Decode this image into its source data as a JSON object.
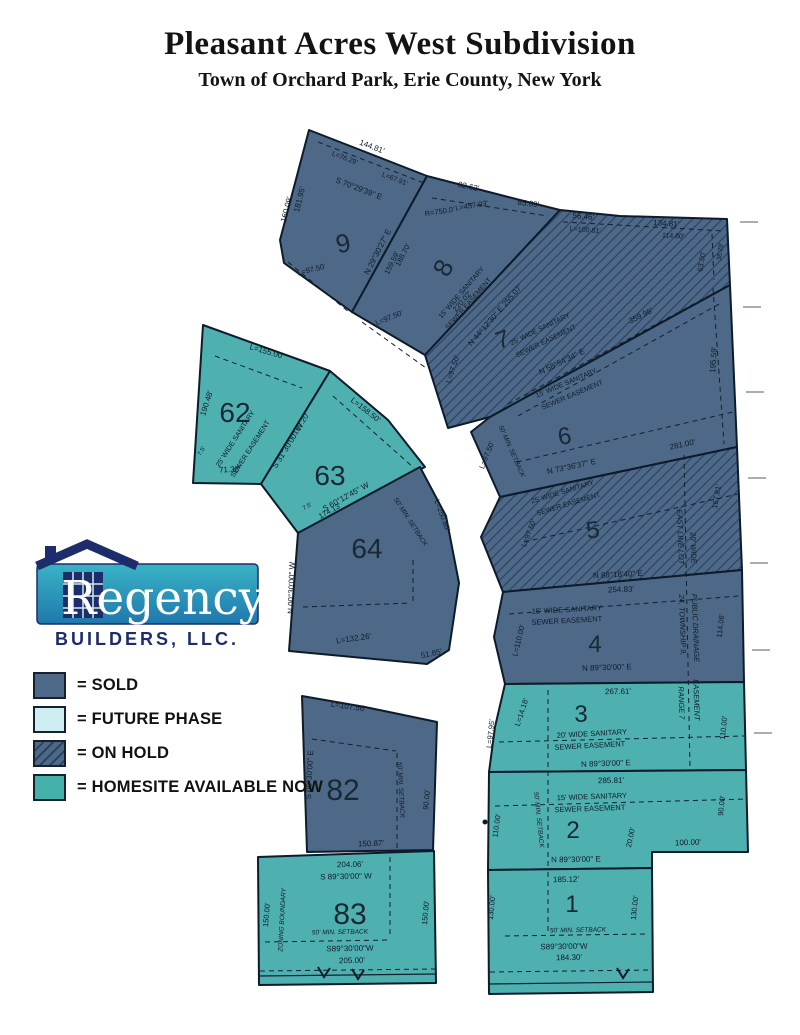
{
  "header": {
    "title": "Pleasant Acres West Subdivision",
    "subtitle": "Town of Orchard Park, Erie County, New York"
  },
  "logo": {
    "name": "Regency",
    "tagline": "BUILDERS, LLC."
  },
  "legend": {
    "items": [
      {
        "label": "= SOLD",
        "type": "sold"
      },
      {
        "label": "= FUTURE PHASE",
        "type": "future"
      },
      {
        "label": "= ON HOLD",
        "type": "onhold"
      },
      {
        "label": "= HOMESITE AVAILABLE NOW",
        "type": "available"
      }
    ]
  },
  "map": {
    "colors": {
      "sold": "#4d6987",
      "avail": "#4fb0b0",
      "legendavail": "#46b0ab",
      "future": "#cfeef2",
      "hatchline": "#2c4265"
    },
    "lots": [
      {
        "number": "1",
        "status": "available"
      },
      {
        "number": "2",
        "status": "available"
      },
      {
        "number": "3",
        "status": "available"
      },
      {
        "number": "4",
        "status": "sold"
      },
      {
        "number": "5",
        "status": "on hold"
      },
      {
        "number": "6",
        "status": "sold"
      },
      {
        "number": "7",
        "status": "on hold"
      },
      {
        "number": "8",
        "status": "sold"
      },
      {
        "number": "9",
        "status": "sold"
      },
      {
        "number": "62",
        "status": "available"
      },
      {
        "number": "63",
        "status": "available"
      },
      {
        "number": "64",
        "status": "sold"
      },
      {
        "number": "82",
        "status": "sold"
      },
      {
        "number": "83",
        "status": "available"
      }
    ],
    "numbers": [
      {
        "n": "9",
        "x": 345,
        "y": 252,
        "r": -12,
        "s": 26
      },
      {
        "n": "8",
        "x": 451,
        "y": 272,
        "r": -62,
        "s": 26
      },
      {
        "n": "7",
        "x": 505,
        "y": 347,
        "r": -18,
        "s": 24
      },
      {
        "n": "6",
        "x": 566,
        "y": 444,
        "r": -10,
        "s": 24
      },
      {
        "n": "5",
        "x": 594,
        "y": 538,
        "r": -8,
        "s": 24
      },
      {
        "n": "4",
        "x": 595,
        "y": 652,
        "r": 0,
        "s": 24
      },
      {
        "n": "3",
        "x": 581,
        "y": 722,
        "r": 0,
        "s": 24
      },
      {
        "n": "2",
        "x": 573,
        "y": 838,
        "r": 0,
        "s": 24
      },
      {
        "n": "1",
        "x": 572,
        "y": 912,
        "r": 0,
        "s": 24
      },
      {
        "n": "62",
        "x": 235,
        "y": 422,
        "r": 0,
        "s": 28
      },
      {
        "n": "63",
        "x": 330,
        "y": 485,
        "r": 0,
        "s": 28
      },
      {
        "n": "64",
        "x": 367,
        "y": 558,
        "r": 0,
        "s": 28
      },
      {
        "n": "82",
        "x": 343,
        "y": 800,
        "r": 0,
        "s": 30
      },
      {
        "n": "83",
        "x": 350,
        "y": 924,
        "r": 0,
        "s": 30
      }
    ],
    "labels": [
      {
        "t": "144.81'",
        "x": 371,
        "y": 149,
        "r": 21
      },
      {
        "t": "L=76.29'",
        "x": 344,
        "y": 160,
        "r": 21,
        "s": 7
      },
      {
        "t": "L=67.91'",
        "x": 394,
        "y": 181,
        "r": 21,
        "s": 7
      },
      {
        "t": "S 70°29'39\" E",
        "x": 358,
        "y": 191,
        "r": 21
      },
      {
        "t": "160.09'",
        "x": 289,
        "y": 210,
        "r": -76
      },
      {
        "t": "181.95'",
        "x": 302,
        "y": 200,
        "r": -76
      },
      {
        "t": "L=97.50'",
        "x": 312,
        "y": 272,
        "r": -14,
        "s": 7.5
      },
      {
        "t": "N 29°30'27\" E",
        "x": 380,
        "y": 253,
        "r": -63
      },
      {
        "t": "159.59'",
        "x": 394,
        "y": 264,
        "r": -63,
        "s": 7.5
      },
      {
        "t": "188.70'",
        "x": 405,
        "y": 256,
        "r": -63,
        "s": 7.5
      },
      {
        "t": "82.62'",
        "x": 468,
        "y": 189,
        "r": 12
      },
      {
        "t": "R=750.0'",
        "x": 440,
        "y": 214,
        "r": -9,
        "s": 7.5
      },
      {
        "t": "L=457.93'",
        "x": 472,
        "y": 208,
        "r": -9,
        "s": 7.5
      },
      {
        "t": "85.69'",
        "x": 528,
        "y": 206,
        "r": 7
      },
      {
        "t": "L=97.50'",
        "x": 390,
        "y": 320,
        "r": -22,
        "s": 7.5
      },
      {
        "t": "15' WIDE SANITARY",
        "x": 463,
        "y": 294,
        "r": -49,
        "s": 7
      },
      {
        "t": "SEWER EASEMENT",
        "x": 470,
        "y": 305,
        "r": -49,
        "s": 7
      },
      {
        "t": "N 44°12'30\" E  255.07'",
        "x": 497,
        "y": 317,
        "r": -49
      },
      {
        "t": "220.02'",
        "x": 464,
        "y": 303,
        "r": -49,
        "s": 7.5
      },
      {
        "t": "L=97.50'",
        "x": 455,
        "y": 370,
        "r": -72,
        "s": 7.5
      },
      {
        "t": "56.46'",
        "x": 583,
        "y": 219,
        "r": 5
      },
      {
        "t": "L=100.81'",
        "x": 585,
        "y": 232,
        "r": 5,
        "s": 7
      },
      {
        "t": "134.81'",
        "x": 666,
        "y": 226,
        "r": 4
      },
      {
        "t": "114.80'",
        "x": 673,
        "y": 238,
        "r": 4,
        "s": 7
      },
      {
        "t": "38.29'",
        "x": 722,
        "y": 252,
        "r": -83,
        "s": 6.5
      },
      {
        "t": "63.30'",
        "x": 704,
        "y": 262,
        "r": -80,
        "s": 7.5
      },
      {
        "t": "25' WIDE SANITARY",
        "x": 541,
        "y": 331,
        "r": -26,
        "s": 7
      },
      {
        "t": "SEWER EASEMENT",
        "x": 547,
        "y": 343,
        "r": -26,
        "s": 7
      },
      {
        "t": "N 58°54'34\" E",
        "x": 563,
        "y": 364,
        "r": -26
      },
      {
        "t": "359.96'",
        "x": 642,
        "y": 318,
        "r": -26
      },
      {
        "t": "195.59'",
        "x": 716,
        "y": 360,
        "r": -86
      },
      {
        "t": "15' WIDE SANITARY",
        "x": 567,
        "y": 385,
        "r": -23,
        "s": 7
      },
      {
        "t": "SEWER EASEMENT",
        "x": 573,
        "y": 397,
        "r": -23,
        "s": 7
      },
      {
        "t": "50' MIN. SETBACK",
        "x": 510,
        "y": 452,
        "r": 66,
        "s": 6.5,
        "i": 1
      },
      {
        "t": "N 73°36'37\" E",
        "x": 572,
        "y": 469,
        "r": -12
      },
      {
        "t": "281.00'",
        "x": 683,
        "y": 447,
        "r": -12
      },
      {
        "t": "L=97.50'",
        "x": 489,
        "y": 456,
        "r": -68,
        "s": 7.5
      },
      {
        "t": "L=97.50'",
        "x": 531,
        "y": 534,
        "r": -68,
        "s": 7.5
      },
      {
        "t": "25' WIDE SANITARY",
        "x": 563,
        "y": 494,
        "r": -17,
        "s": 7
      },
      {
        "t": "SEWER EASEMENT",
        "x": 569,
        "y": 506,
        "r": -17,
        "s": 7
      },
      {
        "t": "N 88°18'40\" E",
        "x": 618,
        "y": 577,
        "r": -3
      },
      {
        "t": "167.81'",
        "x": 719,
        "y": 497,
        "r": -80,
        "s": 7.5
      },
      {
        "t": "EAST LINE LOT",
        "x": 678,
        "y": 537,
        "r": 88,
        "s": 7.5,
        "i": 1
      },
      {
        "t": "24, TOWNSHIP 9,",
        "x": 680,
        "y": 625,
        "r": 88,
        "s": 7.5,
        "i": 1
      },
      {
        "t": "RANGE 7",
        "x": 679,
        "y": 703,
        "r": 88,
        "s": 7.5,
        "i": 1
      },
      {
        "t": "20' WIDE",
        "x": 691,
        "y": 548,
        "r": 88,
        "s": 7.5,
        "i": 1
      },
      {
        "t": "PUBLIC DRAINAGE",
        "x": 693,
        "y": 628,
        "r": 88,
        "s": 7.5,
        "i": 1
      },
      {
        "t": "EASEMENT",
        "x": 694,
        "y": 700,
        "r": 88,
        "s": 7.5,
        "i": 1
      },
      {
        "t": "254.83'",
        "x": 621,
        "y": 592,
        "r": -2
      },
      {
        "t": "15' WIDE SANITARY",
        "x": 567,
        "y": 612,
        "r": -3,
        "s": 7.5
      },
      {
        "t": "SEWER EASEMENT",
        "x": 567,
        "y": 623,
        "r": -3,
        "s": 7.5
      },
      {
        "t": "N 89°30'00\" E",
        "x": 607,
        "y": 670,
        "r": -2
      },
      {
        "t": "L=110.00'",
        "x": 521,
        "y": 641,
        "r": -76,
        "s": 7.5
      },
      {
        "t": "114.06'",
        "x": 723,
        "y": 626,
        "r": -84,
        "s": 7.5
      },
      {
        "t": "267.61'",
        "x": 618,
        "y": 694,
        "r": -1
      },
      {
        "t": "20' WIDE SANITARY",
        "x": 592,
        "y": 736,
        "r": -3,
        "s": 7.5
      },
      {
        "t": "SEWER EASEMENT",
        "x": 590,
        "y": 748,
        "r": -3,
        "s": 7.5
      },
      {
        "t": "N 89°30'00\" E",
        "x": 606,
        "y": 766,
        "r": -2
      },
      {
        "t": "L=14.18'",
        "x": 524,
        "y": 713,
        "r": -72,
        "s": 7.5
      },
      {
        "t": "L=97.95'",
        "x": 493,
        "y": 734,
        "r": -84,
        "s": 7.5
      },
      {
        "t": "110.00'",
        "x": 726,
        "y": 728,
        "r": -84,
        "s": 7.5
      },
      {
        "t": "285.81'",
        "x": 611,
        "y": 783,
        "r": -1
      },
      {
        "t": "15' WIDE SANITARY",
        "x": 592,
        "y": 799,
        "r": -2,
        "s": 7.5
      },
      {
        "t": "SEWER EASEMENT",
        "x": 590,
        "y": 811,
        "r": -2,
        "s": 7.5
      },
      {
        "t": "50' MIN. SETBACK",
        "x": 537,
        "y": 820,
        "r": 84,
        "s": 6.5,
        "i": 1
      },
      {
        "t": "110.00'",
        "x": 499,
        "y": 826,
        "r": -82,
        "s": 7.5
      },
      {
        "t": "N 89°30'00\" E",
        "x": 576,
        "y": 862,
        "r": -1
      },
      {
        "t": "20.00'",
        "x": 633,
        "y": 838,
        "r": -78,
        "s": 7.5
      },
      {
        "t": "100.00'",
        "x": 688,
        "y": 845,
        "r": -2
      },
      {
        "t": "90.00'",
        "x": 724,
        "y": 806,
        "r": -84,
        "s": 7.5
      },
      {
        "t": "185.12'",
        "x": 566,
        "y": 882,
        "r": -1
      },
      {
        "t": "130.00'",
        "x": 494,
        "y": 908,
        "r": -84,
        "s": 7.5
      },
      {
        "t": "130.00'",
        "x": 637,
        "y": 908,
        "r": -84,
        "s": 7.5
      },
      {
        "t": "50' MIN. SETBACK",
        "x": 578,
        "y": 932,
        "r": -1,
        "s": 6.5,
        "i": 1
      },
      {
        "t": "S89°30'00\"W",
        "x": 564,
        "y": 949,
        "r": -1
      },
      {
        "t": "184.30'",
        "x": 569,
        "y": 960,
        "r": -1
      },
      {
        "t": "L=107.56'",
        "x": 348,
        "y": 709,
        "r": 8
      },
      {
        "t": "S 00°30'00\" E",
        "x": 312,
        "y": 775,
        "r": -87
      },
      {
        "t": "50' MIN. SETBACK",
        "x": 399,
        "y": 790,
        "r": 87,
        "s": 6.5,
        "i": 1
      },
      {
        "t": "90.00'",
        "x": 429,
        "y": 800,
        "r": -84,
        "s": 7.5
      },
      {
        "t": "150.87'",
        "x": 371,
        "y": 846,
        "r": -2
      },
      {
        "t": "204.06'",
        "x": 350,
        "y": 867,
        "r": -1
      },
      {
        "t": "S 89°30'00\" W",
        "x": 346,
        "y": 879,
        "r": -1
      },
      {
        "t": "150.00'",
        "x": 269,
        "y": 915,
        "r": -85,
        "s": 7.5
      },
      {
        "t": "ZONING BOUNDARY",
        "x": 284,
        "y": 920,
        "r": -87,
        "s": 6.5,
        "i": 1
      },
      {
        "t": "50' MIN. SETBACK",
        "x": 340,
        "y": 934,
        "r": -1,
        "s": 6.5,
        "i": 1
      },
      {
        "t": "S89°30'00\"W",
        "x": 350,
        "y": 951,
        "r": -1
      },
      {
        "t": "205.00'",
        "x": 352,
        "y": 963,
        "r": -1
      },
      {
        "t": "150.00'",
        "x": 428,
        "y": 913,
        "r": -85,
        "s": 7.5
      },
      {
        "t": "L=155.00'",
        "x": 266,
        "y": 354,
        "r": 16
      },
      {
        "t": "190.48'",
        "x": 209,
        "y": 404,
        "r": -72
      },
      {
        "t": "25' WIDE SANITARY",
        "x": 237,
        "y": 440,
        "r": -57,
        "s": 7
      },
      {
        "t": "SEWER EASEMENT",
        "x": 252,
        "y": 450,
        "r": -57,
        "s": 7
      },
      {
        "t": "7.5'",
        "x": 203,
        "y": 452,
        "r": -57,
        "s": 6
      },
      {
        "t": "71.38'",
        "x": 230,
        "y": 472,
        "r": -3
      },
      {
        "t": "S 31°30'00\" W",
        "x": 290,
        "y": 447,
        "r": -58
      },
      {
        "t": "167.20'",
        "x": 303,
        "y": 425,
        "r": -58,
        "s": 7.5
      },
      {
        "t": "L=158.50'",
        "x": 364,
        "y": 412,
        "r": 38
      },
      {
        "t": "7.5'",
        "x": 308,
        "y": 508,
        "r": -29,
        "s": 6
      },
      {
        "t": "S 60°12'45\" W",
        "x": 347,
        "y": 499,
        "r": -29
      },
      {
        "t": "174.13'",
        "x": 331,
        "y": 513,
        "r": -29,
        "s": 7.5
      },
      {
        "t": "N 00°30'00\" W",
        "x": 294,
        "y": 588,
        "r": -88
      },
      {
        "t": "50' MIN. SETBACK",
        "x": 409,
        "y": 523,
        "r": 57,
        "s": 6.5,
        "i": 1
      },
      {
        "t": "L=250.80'",
        "x": 440,
        "y": 516,
        "r": 70,
        "s": 7.5
      },
      {
        "t": "L=132.26'",
        "x": 354,
        "y": 641,
        "r": -8
      },
      {
        "t": "51.85'",
        "x": 432,
        "y": 656,
        "r": -12
      }
    ]
  }
}
